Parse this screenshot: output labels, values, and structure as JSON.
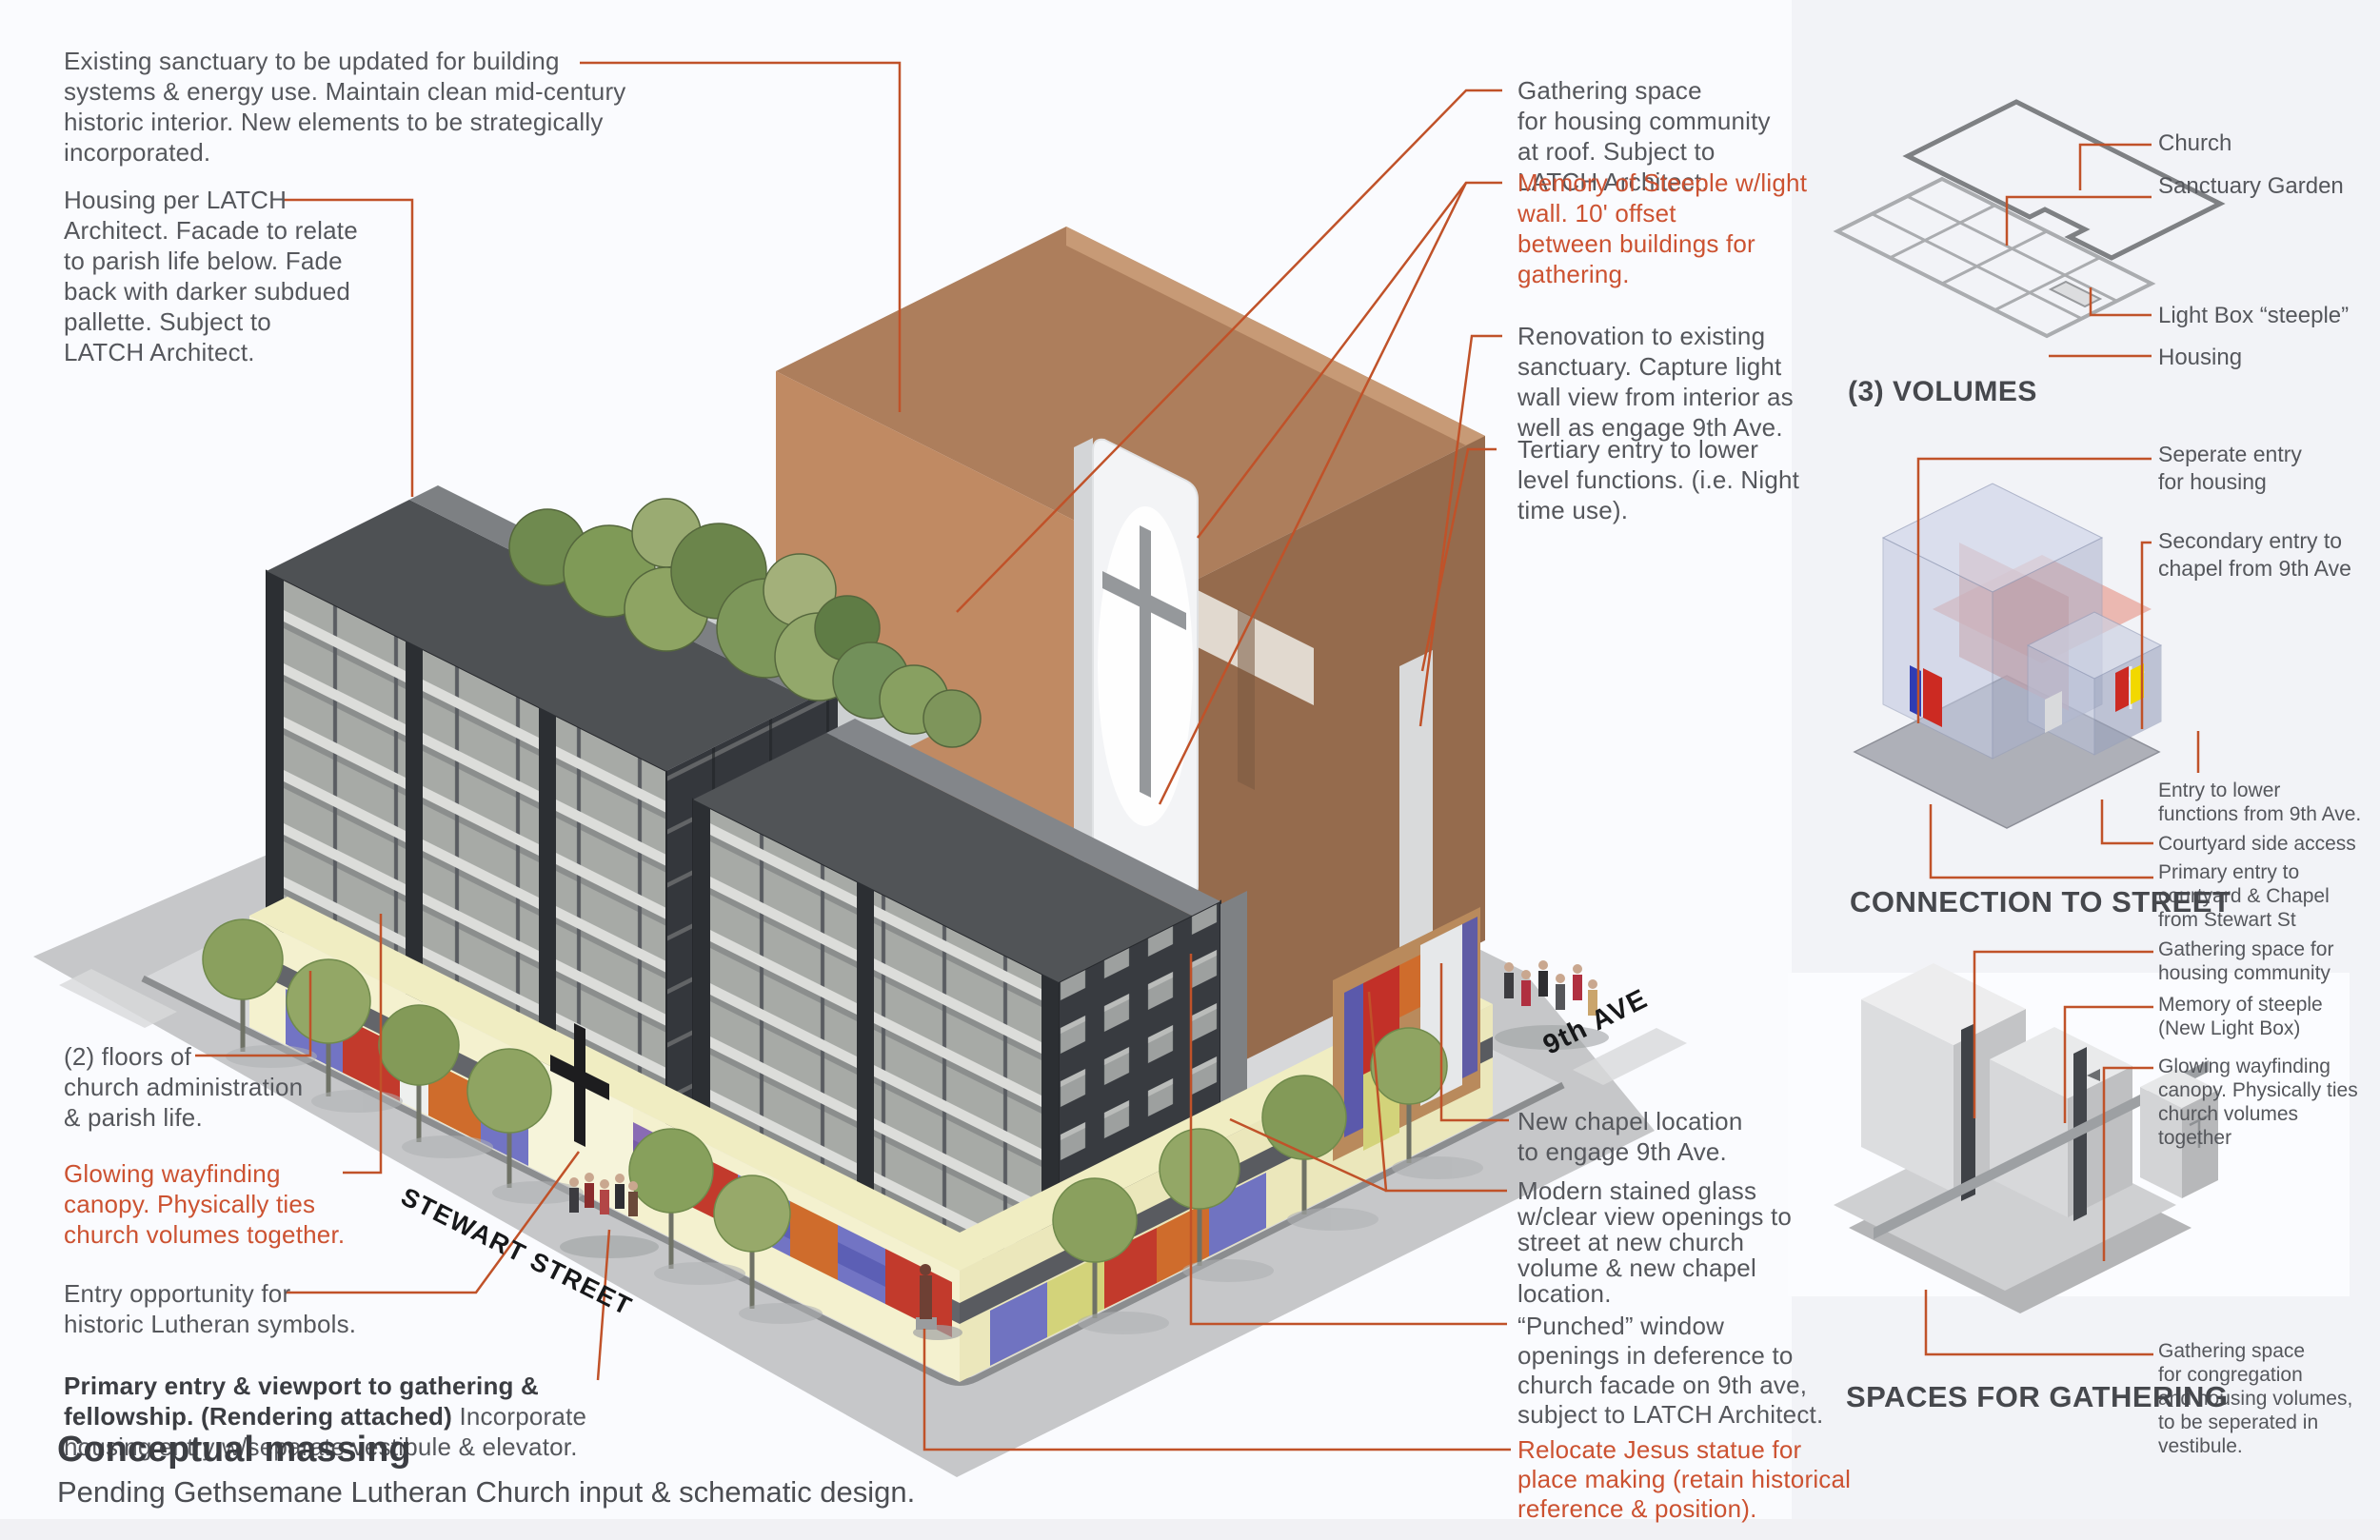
{
  "page": {
    "background": "#f2f3f7",
    "panel": "#fafbfe",
    "accent_line": "#c05229",
    "orange_text": "#cc5231",
    "gray_text": "#55575c",
    "bold_text": "#3b3d42"
  },
  "streets": {
    "stewart_label": "STEWART STREET",
    "ninth_label": "9th AVE"
  },
  "footer": {
    "title": "Conceptual massing",
    "subtitle": "Pending Gethsemane Lutheran Church input & schematic design."
  },
  "annotations": {
    "existing_sanctuary": "Existing sanctuary to be updated for building\nsystems & energy use.  Maintain clean mid-century\nhistoric interior. New elements to be strategically\nincorporated.",
    "housing_latch": "Housing per LATCH\nArchitect.  Facade to relate\nto parish life below. Fade\nback with darker subdued\npallette.  Subject to\nLATCH Architect.",
    "gathering_roof": "Gathering space\nfor housing community\nat roof. Subject to\nLATCH Architect.",
    "memory_steeple": "Memory of Steeple w/light\nwall.  10' offset\nbetween buildings for\ngathering.",
    "renovation": "Renovation to existing\nsanctuary.  Capture light\nwall view from interior as\nwell as engage 9th Ave.",
    "tertiary_entry": "Tertiary entry to lower\nlevel functions. (i.e. Night\ntime use).",
    "admin_floors": "(2) floors of\nchurch administration\n& parish life.",
    "glowing_canopy": "Glowing wayfinding\ncanopy. Physically ties\nchurch volumes together.",
    "entry_opportunity": "Entry opportunity for\nhistoric Lutheran symbols.",
    "primary_entry_bold": "Primary entry & viewport to gathering & fellowship. (Rendering attached)",
    "primary_entry_rest": "Incorporate housing entry w/separate vestibule & elevator.",
    "new_chapel": "New chapel location\nto engage 9th Ave.",
    "stained_glass": "Modern stained glass\nw/clear view openings to\nstreet at new church\nvolume & new chapel\nlocation.",
    "punched_window": "“Punched” window\nopenings in deference to\nchurch facade on 9th ave,\nsubject to LATCH Architect.",
    "relocate_statue": "Relocate Jesus statue for\nplace making (retain historical\nreference & position)."
  },
  "diagrams": {
    "volumes": {
      "title": "(3) VOLUMES",
      "labels": [
        "Church",
        "Sanctuary Garden",
        "Light Box “steeple”",
        "Housing"
      ]
    },
    "connection": {
      "title": "CONNECTION TO STREET",
      "labels": [
        "Seperate entry\nfor housing",
        "Secondary entry to\nchapel from 9th Ave",
        "Entry to lower\nfunctions from 9th Ave.",
        "Courtyard side access",
        "Primary entry to\ncourtyard & Chapel\nfrom Stewart St"
      ]
    },
    "gathering": {
      "title": "SPACES FOR GATHERING",
      "labels": [
        "Gathering space for\nhousing community",
        "Memory of steeple\n(New Light Box)",
        "Glowing wayfinding\ncanopy. Physically ties\nchurch volumes\ntogether",
        "Gathering space\nfor congregation\nand housing volumes,\nto be seperated in\nvestibule."
      ]
    }
  }
}
